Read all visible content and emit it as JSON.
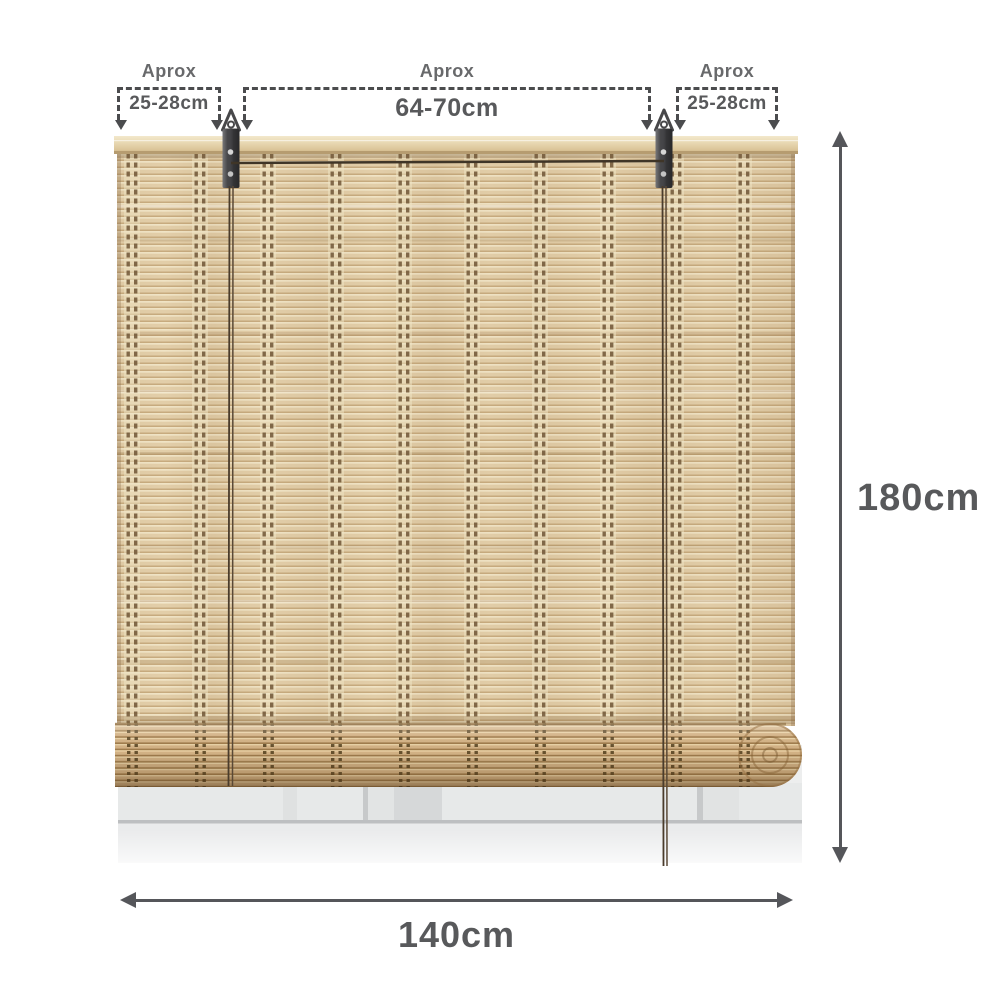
{
  "measurements": {
    "top_left": {
      "label": "Aprox",
      "value": "25-28cm"
    },
    "top_center": {
      "label": "Aprox",
      "value": "64-70cm"
    },
    "top_right": {
      "label": "Aprox",
      "value": "25-28cm"
    },
    "height": {
      "value": "180cm"
    },
    "width": {
      "value": "140cm"
    }
  },
  "colors": {
    "dimension_text": "#58595b",
    "dimension_line": "#55565a",
    "dashed_guide": "#4b4c4e",
    "approx_label_text": "#68696b",
    "bamboo_highlight": "#f2e6c8",
    "bamboo_base": "#e4d0ab",
    "bamboo_shadow": "#c8ac80",
    "stitch_thread": "#6e5535",
    "roll_base": "#d3b285",
    "head_rail": "#e8d9b4",
    "bracket_metal": "#3c3c3f",
    "window_frame": "#eaebec"
  }
}
